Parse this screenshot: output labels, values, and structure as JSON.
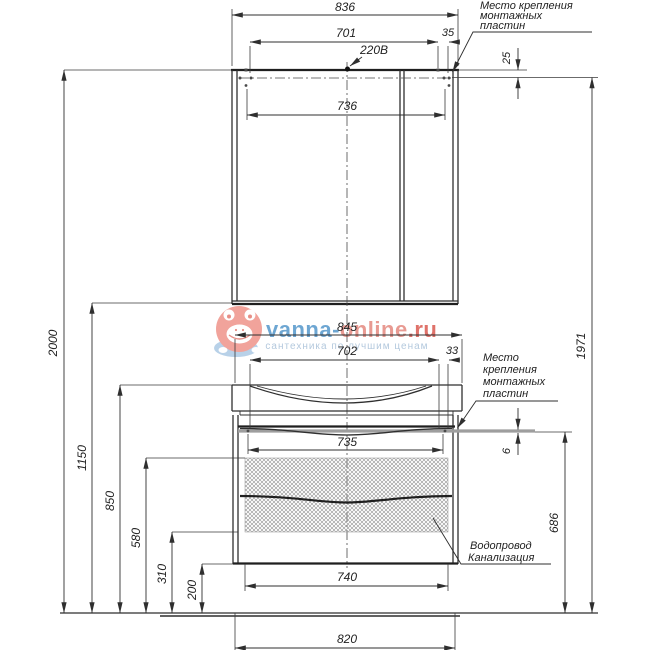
{
  "watermark": {
    "brand_primary": "vanna-",
    "brand_secondary": "online",
    "brand_tld": ".ru",
    "tagline": "сантехника по лучшим ценам",
    "color_blue": "#4e93c9",
    "color_salmon": "#e4857b",
    "color_red": "#d9544a",
    "color_light_blue": "#a3bdd6",
    "icon": "frog-mascot-icon"
  },
  "annotations": {
    "outlet": "220В",
    "mount_top": [
      "Место крепления",
      "монтажных",
      "пластин"
    ],
    "mount_mid": [
      "Место",
      "крепления",
      "монтажных",
      "пластин"
    ],
    "plumbing": [
      "Водопровод",
      "Канализация"
    ]
  },
  "dims": {
    "d836": "836",
    "d701": "701",
    "d35": "35",
    "d736": "736",
    "d25": "25",
    "d2000": "2000",
    "d1150": "1150",
    "d850": "850",
    "d580": "580",
    "d310": "310",
    "d200": "200",
    "d1971": "1971",
    "d845": "845",
    "d702": "702",
    "d33": "33",
    "d735": "735",
    "d6": "6",
    "d686": "686",
    "d740": "740",
    "d820": "820"
  }
}
